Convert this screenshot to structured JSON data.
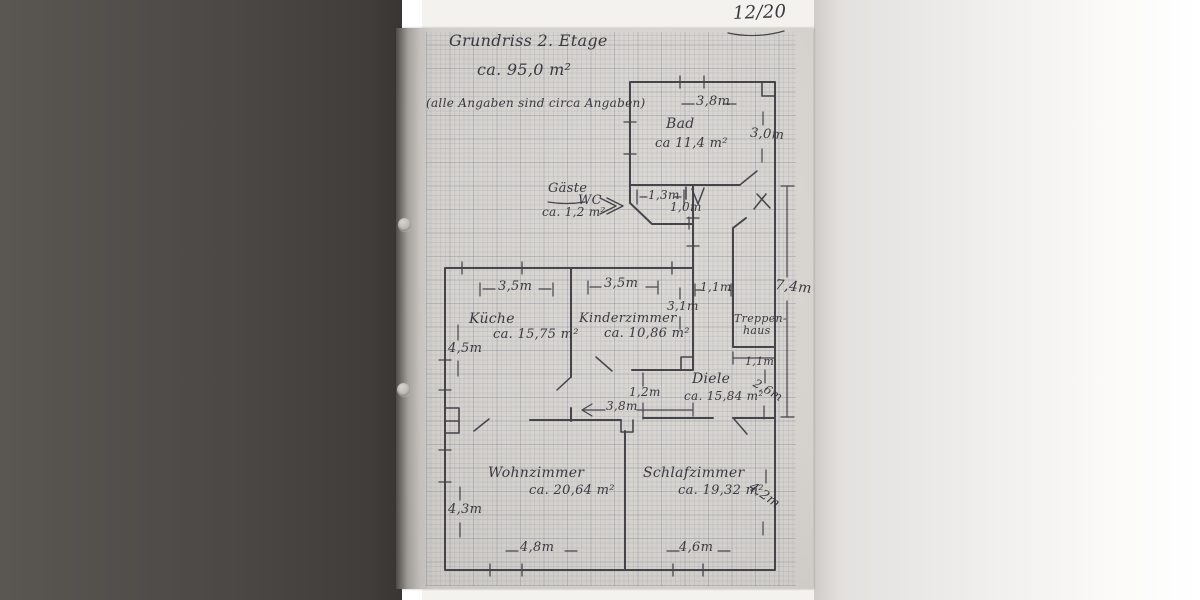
{
  "page_number": "12/20",
  "header": {
    "title": "Grundriss 2. Etage",
    "total_area": "ca. 95,0 m²",
    "note": "(alle Angaben sind circa Angaben)"
  },
  "rooms": {
    "bad": {
      "name": "Bad",
      "area": "ca 11,4 m²",
      "width": "3,8m",
      "height": "3,0m"
    },
    "gaeste_wc": {
      "name_line1": "Gäste",
      "name_line2": "WC",
      "area": "ca. 1,2 m²",
      "width": "1,3m",
      "height": "1,0m"
    },
    "kueche": {
      "name": "Küche",
      "area": "ca. 15,75 m²",
      "width": "3,5m",
      "height": "4,5m"
    },
    "kinderzimmer": {
      "name": "Kinderzimmer",
      "area": "ca. 10,86 m²",
      "width": "3,5m",
      "height": "3,1m"
    },
    "treppenhaus": {
      "name_line1": "Treppen-",
      "name_line2": "haus",
      "width": "1,1m"
    },
    "diele": {
      "name": "Diele",
      "area": "ca. 15,84 m²",
      "width": "3,8m",
      "height": "1,2m",
      "south_height": "2,6m"
    },
    "wohnzimmer": {
      "name": "Wohnzimmer",
      "area": "ca. 20,64 m²",
      "width": "4,8m",
      "height": "4,3m"
    },
    "schlafzimmer": {
      "name": "Schlafzimmer",
      "area": "ca. 19,32 m²",
      "width": "4,6m",
      "height": "4,2m"
    }
  },
  "dimensions": {
    "corridor_width": "1,1m",
    "corridor_length": "7,4m"
  },
  "colors": {
    "paper": "#d8d5d0",
    "ink": "#3a3940",
    "background_left": "#4b4744",
    "background_right": "#f4f3f1",
    "grid_line": "#6270a0"
  }
}
